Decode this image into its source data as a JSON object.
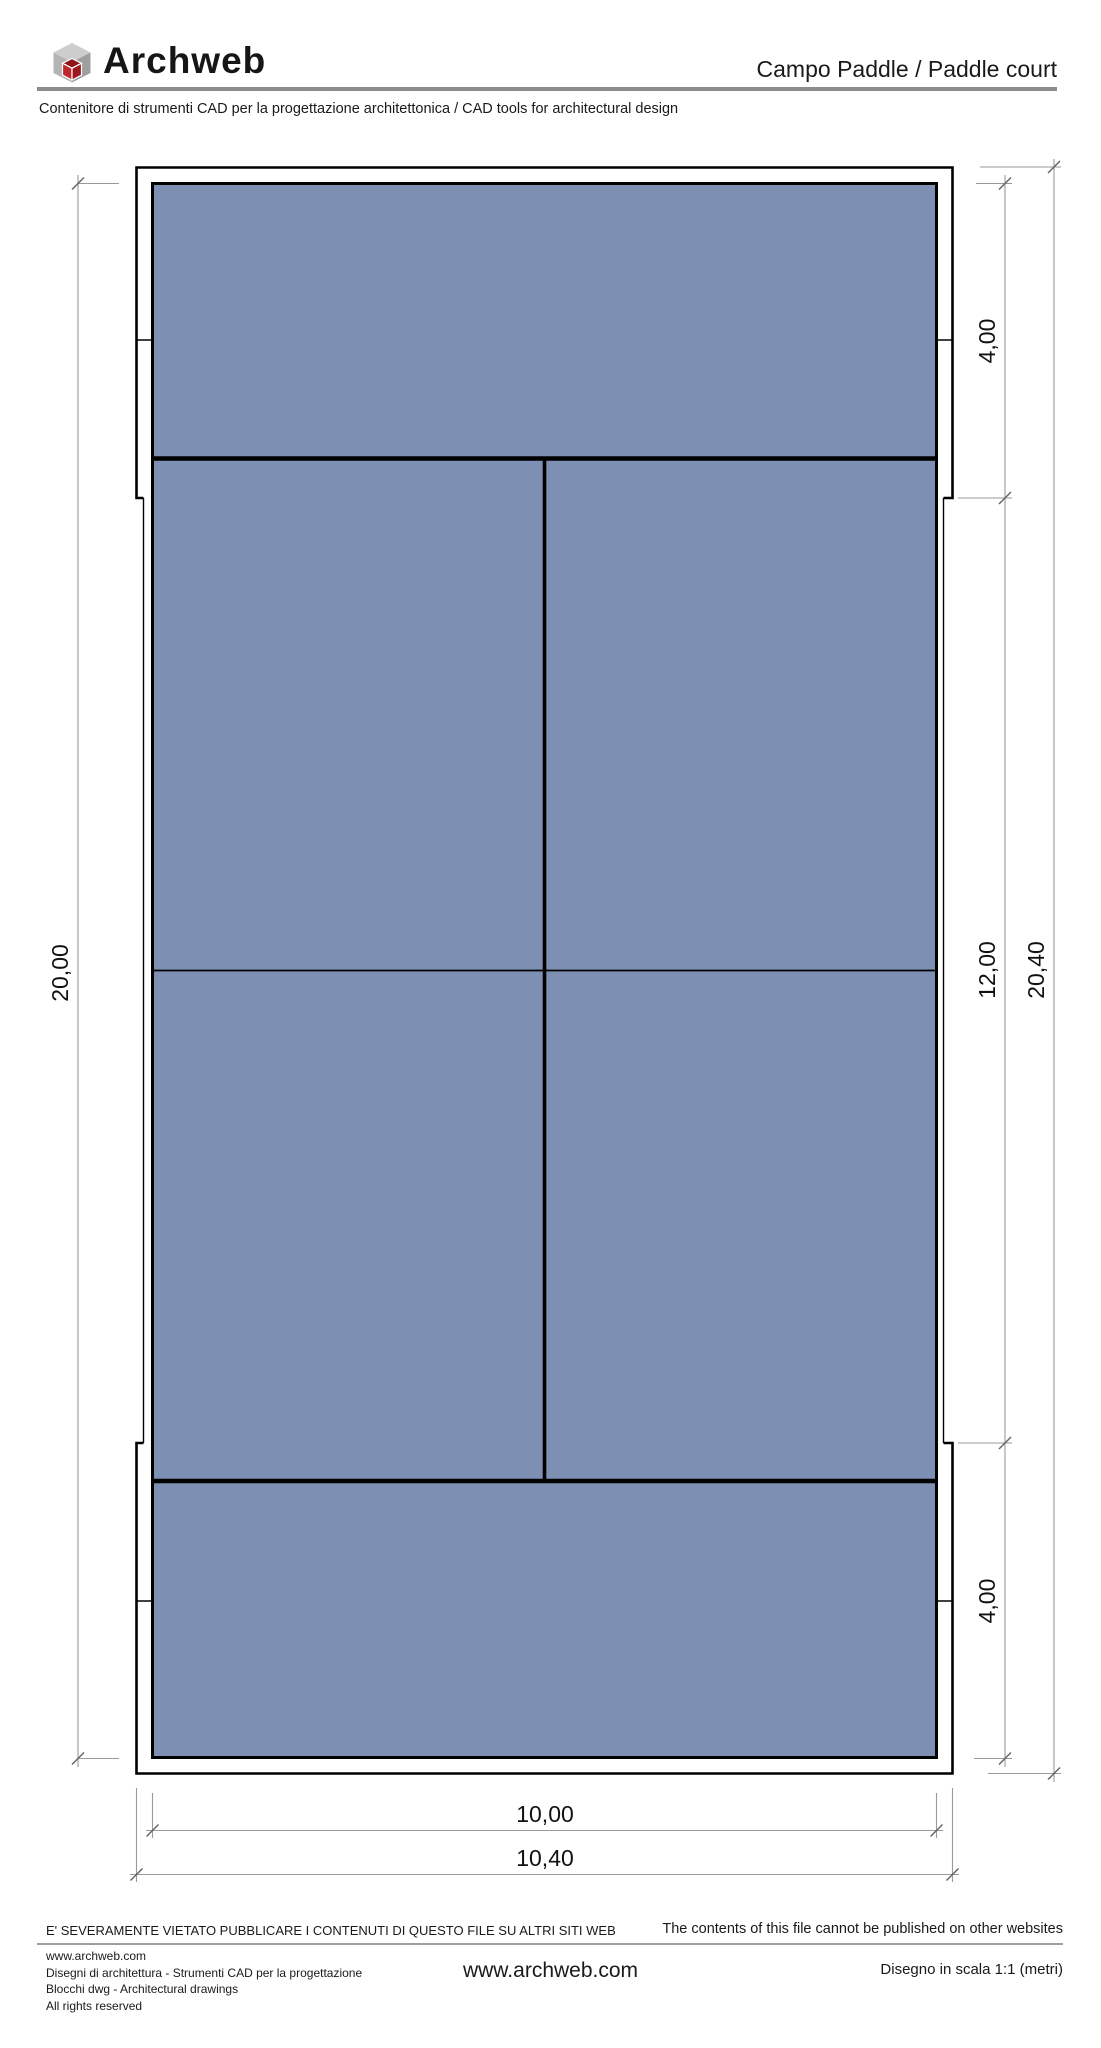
{
  "header": {
    "logo": {
      "text": "Archweb",
      "icon": "cube-logo"
    },
    "title": "Campo Paddle / Paddle court",
    "subtitle": "Contenitore di strumenti CAD per la progettazione architettonica  /  CAD tools for architectural design",
    "rule_color": "#8c8c8c"
  },
  "drawing": {
    "type": "paddle-court-plan",
    "court_fill": "#7d8fb3",
    "dimensions": {
      "court_length": "20,00",
      "panel_top": "4,00",
      "panel_middle": "12,00",
      "panel_bottom": "4,00",
      "overall_length": "20,40",
      "court_width": "10,00",
      "overall_width": "10,40"
    }
  },
  "footer": {
    "notice_it": "E' SEVERAMENTE VIETATO PUBBLICARE I CONTENUTI DI QUESTO FILE SU ALTRI SITI WEB",
    "notice_en": "The contents of this file cannot be published on other websites",
    "info_lines": [
      "www.archweb.com",
      "Disegni di architettura - Strumenti CAD  per la progettazione",
      "Blocchi dwg - Architectural drawings",
      "All rights reserved"
    ],
    "website": "www.archweb.com",
    "scale_note": "Disegno in scala 1:1 (metri)"
  }
}
